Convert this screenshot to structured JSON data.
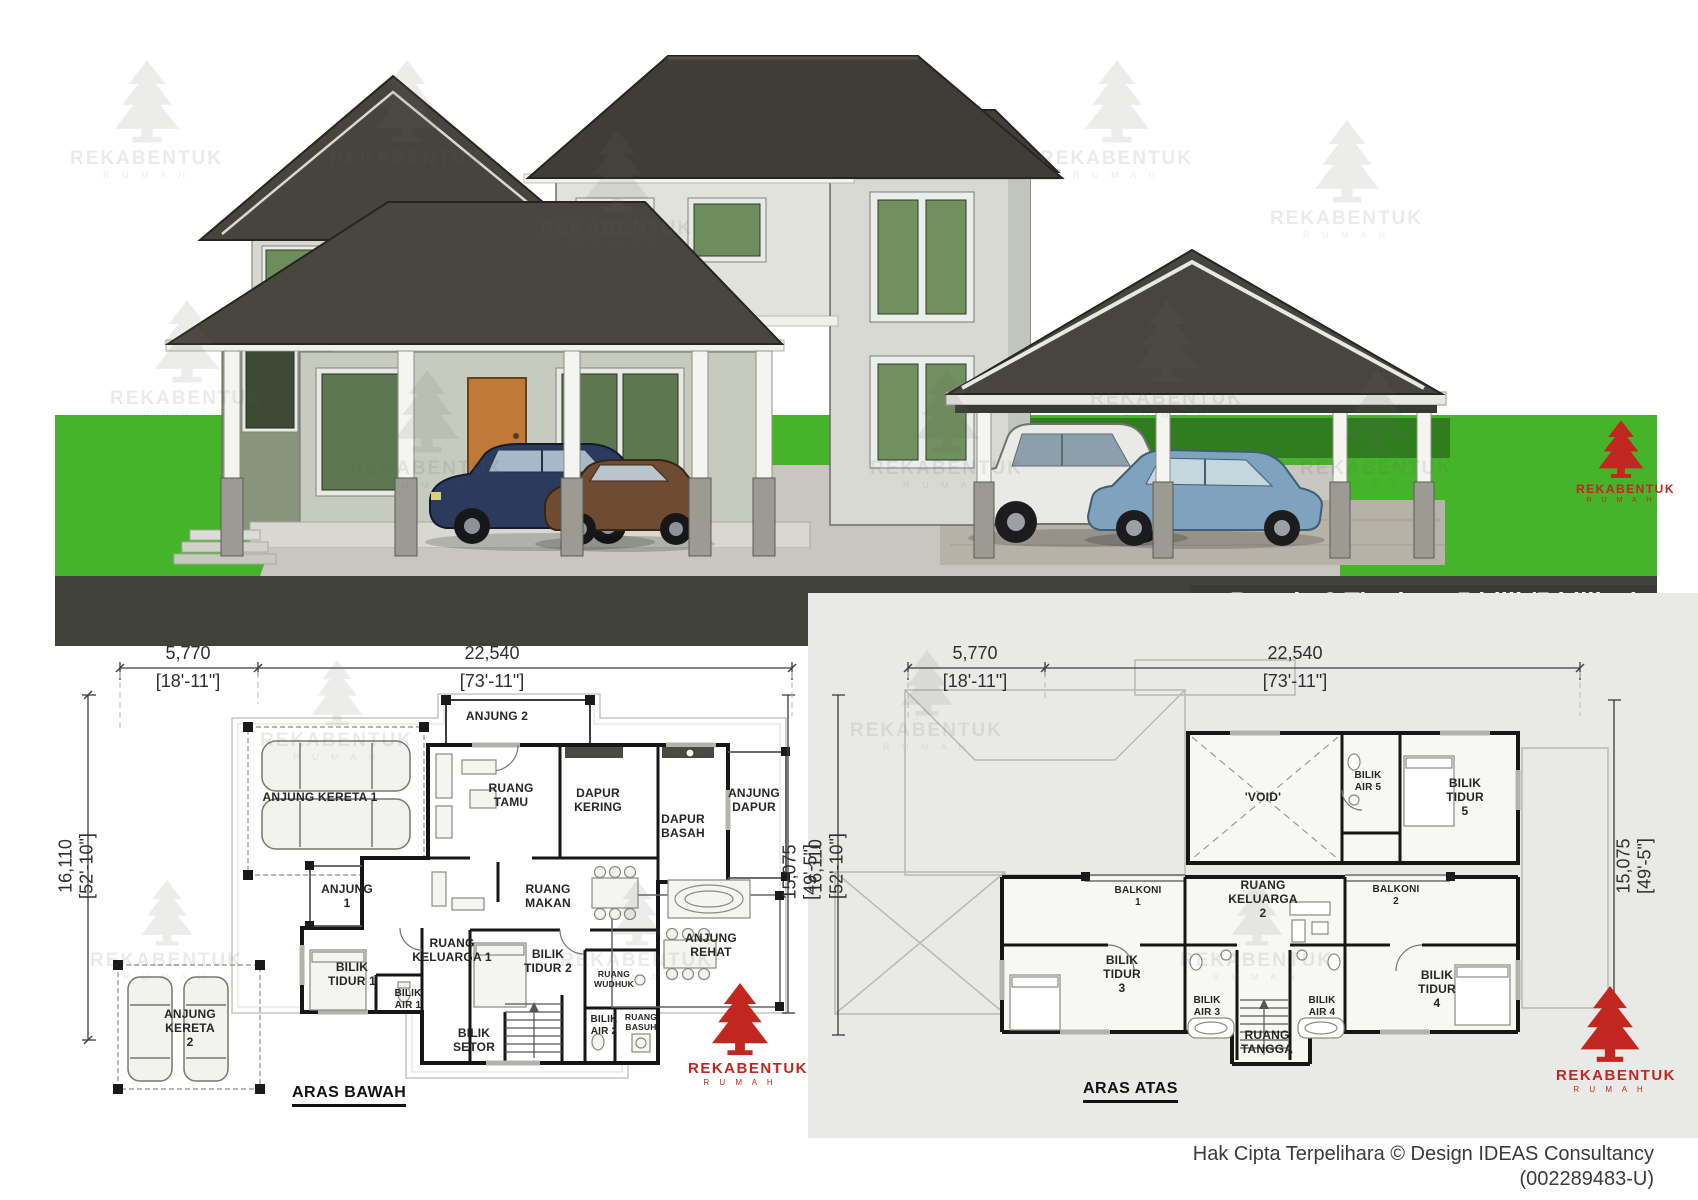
{
  "banner": {
    "line1": "Banglo 2 Tingkat - 5 bilik/5 bilik air",
    "line2": "5082kaki persegi",
    "bg_color": "#3a3a38",
    "text_color": "#ffffff"
  },
  "brand": {
    "name": "REKABENTUK",
    "sub": "R U M A H",
    "color": "#c1271f"
  },
  "watermark": {
    "name": "REKABENTUK",
    "sub": "R U M A H"
  },
  "footer": {
    "line1": "Hak Cipta Terpelihara  © Design IDEAS Consultancy",
    "line2": "(002289483-U)"
  },
  "plan_bawah": {
    "caption": "ARAS BAWAH",
    "dims": {
      "a_mm": "5,770",
      "a_ft": "[18'-11\"]",
      "b_mm": "22,540",
      "b_ft": "[73'-11\"]",
      "left_mm": "16,110",
      "left_ft": "[52'-10\"]",
      "right_mm": "15,075",
      "right_ft": "[49'-5\"]"
    },
    "rooms": {
      "anjung2": "ANJUNG 2",
      "anjung_kereta1": "ANJUNG KERETA 1",
      "ruang_tamu": "RUANG\nTAMU",
      "dapur_kering": "DAPUR\nKERING",
      "dapur_basah": "DAPUR\nBASAH",
      "anjung_dapur": "ANJUNG\nDAPUR",
      "anjung1": "ANJUNG\n1",
      "ruang_makan": "RUANG\nMAKAN",
      "ruang_keluarga1": "RUANG\nKELUARGA 1",
      "anjung_rehat": "ANJUNG\nREHAT",
      "bilik_tidur1": "BILIK\nTIDUR 1",
      "bilik_air1": "BILIK\nAIR 1",
      "bilik_tidur2": "BILIK\nTIDUR 2",
      "ruang_wudhuk": "RUANG\nWUDHUK",
      "bilik_air2": "BILIK\nAIR 2",
      "ruang_basuh": "RUANG\nBASUH",
      "bilik_setor": "BILIK\nSETOR",
      "anjung_kereta2": "ANJUNG\nKERETA\n2"
    }
  },
  "plan_atas": {
    "caption": "ARAS ATAS",
    "dims": {
      "a_mm": "5,770",
      "a_ft": "[18'-11\"]",
      "b_mm": "22,540",
      "b_ft": "[73'-11\"]",
      "left_mm": "16,110",
      "left_ft": "[52'-10\"]",
      "right_mm": "15,075",
      "right_ft": "[49'-5\"]"
    },
    "rooms": {
      "void": "'VOID'",
      "bilik_air5": "BILIK\nAIR 5",
      "bilik_tidur5": "BILIK\nTIDUR\n5",
      "balkoni1": "BALKONI\n1",
      "ruang_keluarga2": "RUANG\nKELUARGA\n2",
      "balkoni2": "BALKONI\n2",
      "bilik_tidur3": "BILIK\nTIDUR\n3",
      "bilik_air3": "BILIK\nAIR 3",
      "bilik_air4": "BILIK\nAIR 4",
      "bilik_tidur4": "BILIK\nTIDUR\n4",
      "ruang_tangga": "RUANG\nTANGGA"
    }
  }
}
